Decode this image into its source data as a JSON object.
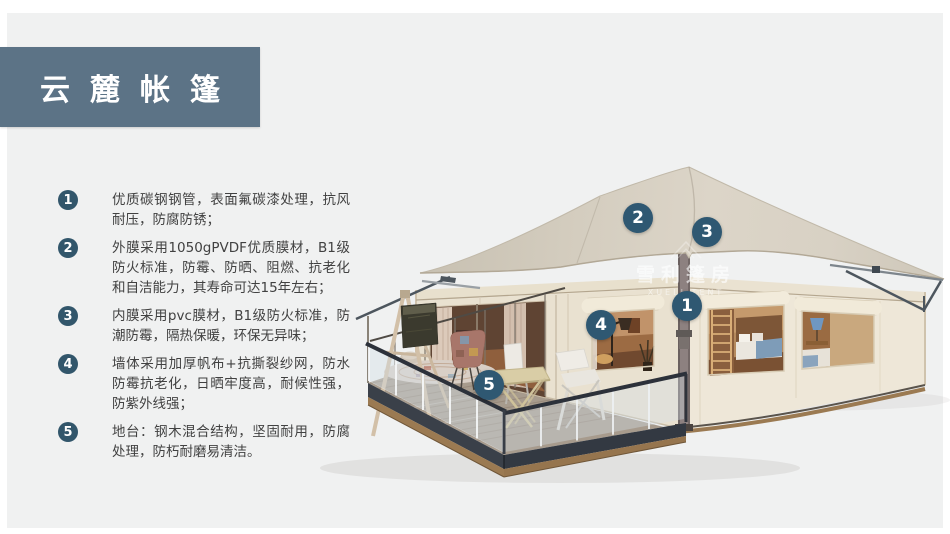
{
  "page": {
    "type": "product-presentation-slide",
    "colors": {
      "background": "#f0f1f1",
      "banner": "#5c7386",
      "badge": "#32566b",
      "tent_marker": "#2f5872",
      "body_text": "#414141",
      "roof_beige": "#d6cfc2",
      "wall_cream": "#e9e1d0",
      "deck_wood": "#9b7a52"
    }
  },
  "header": {
    "title": "云麓帐篷"
  },
  "features": [
    {
      "num": "1",
      "text": "优质碳钢钢管，表面氟碳漆处理，抗风耐压，防腐防锈；"
    },
    {
      "num": "2",
      "text": "外膜采用1050gPVDF优质膜材，B1级防火标准，防霉、防晒、阻燃、抗老化和自洁能力，其寿命可达15年左右；"
    },
    {
      "num": "3",
      "text": "内膜采用pvc膜材，B1级防火标准，防潮防霉，隔热保暖，环保无异味；"
    },
    {
      "num": "4",
      "text": "墙体采用加厚帆布+抗撕裂纱网，防水防霉抗老化，日晒牢度高，耐候性强，防紫外线强；"
    },
    {
      "num": "5",
      "text": "地台：钢木混合结构，坚固耐用，防腐处理，防朽耐磨易清洁。"
    }
  ],
  "illustration": {
    "subject": "glamping-safari-tent-3d-render",
    "markers": [
      {
        "num": "1",
        "x": 687,
        "y": 306
      },
      {
        "num": "2",
        "x": 638,
        "y": 218
      },
      {
        "num": "3",
        "x": 707,
        "y": 232
      },
      {
        "num": "4",
        "x": 601,
        "y": 325
      },
      {
        "num": "5",
        "x": 489,
        "y": 385
      }
    ],
    "watermark": {
      "icon": "tent-peak-icon",
      "cn": "雪利篷房",
      "en": "XUELI TENT"
    }
  }
}
